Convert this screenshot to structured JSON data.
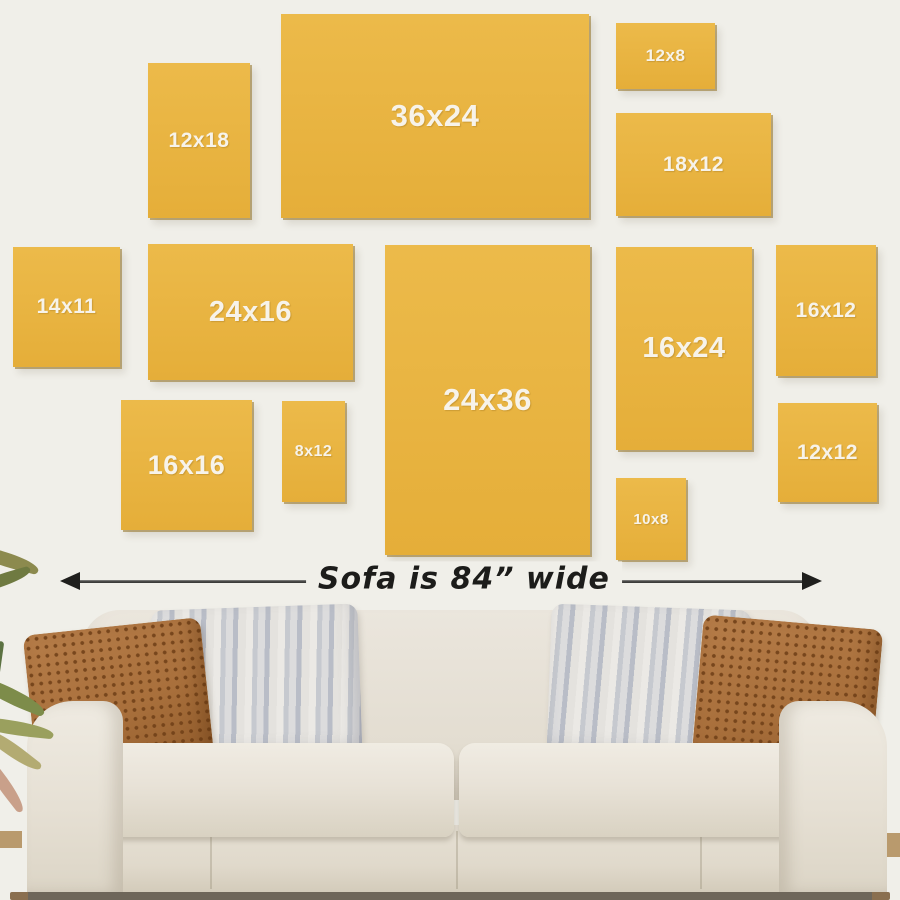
{
  "scene": {
    "background_color": "#f0efe9",
    "frame_fill_color": "#e9b544",
    "frame_label_color": "#f7f3ea",
    "description": "Wall-art size guide showing canvas print sizes hung above a sofa"
  },
  "frames": [
    {
      "label": "12x18",
      "width_in": 12,
      "height_in": 18
    },
    {
      "label": "36x24",
      "width_in": 36,
      "height_in": 24
    },
    {
      "label": "12x8",
      "width_in": 12,
      "height_in": 8
    },
    {
      "label": "18x12",
      "width_in": 18,
      "height_in": 12
    },
    {
      "label": "14x11",
      "width_in": 14,
      "height_in": 11
    },
    {
      "label": "24x16",
      "width_in": 24,
      "height_in": 16
    },
    {
      "label": "24x36",
      "width_in": 24,
      "height_in": 36
    },
    {
      "label": "16x24",
      "width_in": 16,
      "height_in": 24
    },
    {
      "label": "16x12",
      "width_in": 16,
      "height_in": 12
    },
    {
      "label": "16x16",
      "width_in": 16,
      "height_in": 16
    },
    {
      "label": "8x12",
      "width_in": 8,
      "height_in": 12
    },
    {
      "label": "10x8",
      "width_in": 10,
      "height_in": 8
    },
    {
      "label": "12x12",
      "width_in": 12,
      "height_in": 12
    }
  ],
  "sofa": {
    "width_note": "Sofa is 84” wide",
    "width_inches": 84
  }
}
